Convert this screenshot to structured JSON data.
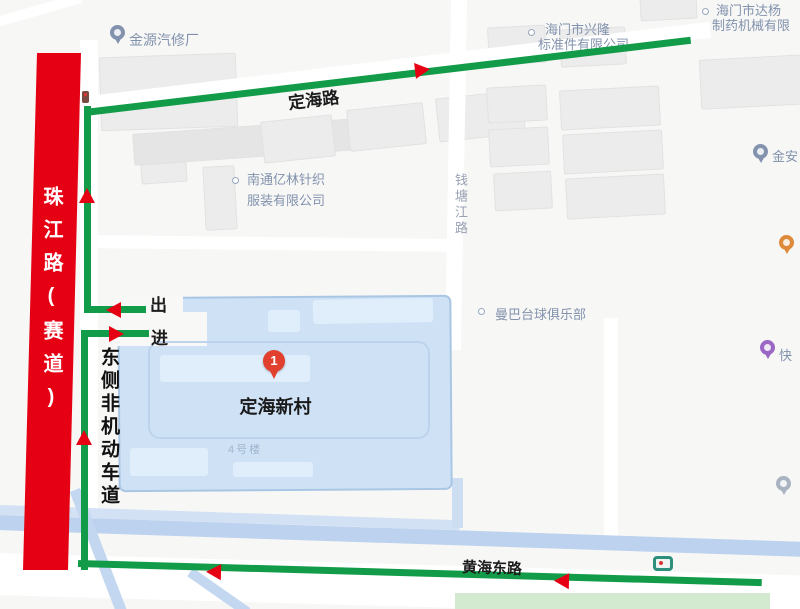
{
  "roads": {
    "dinghai": "定海路",
    "huanghai_east": "黄海东路",
    "zhujiang_racetrack": "珠江路(赛道)",
    "qiantangjiang": "钱塘江路",
    "east_non_motor_lane": "东侧非机动车道"
  },
  "route": {
    "exit_gate": "出",
    "enter_gate": "进"
  },
  "destination": {
    "marker_number": "1",
    "name": "定海新村",
    "building": "4号楼"
  },
  "pois": {
    "jinyuan_auto": "金源汽修厂",
    "xinglong": {
      "line1": "海门市兴隆",
      "line2": "标准件有限公司"
    },
    "dayang": {
      "line1": "海门市达杨",
      "line2": "制药机械有限"
    },
    "yilin": {
      "line1": "南通亿林针织",
      "line2": "服装有限公司"
    },
    "jinan": "金安",
    "manba_billiards": "曼巴台球俱乐部",
    "kuai": "快"
  },
  "colors": {
    "route_green": "#129c49",
    "closed_road_red": "#e60013",
    "arrow_red": "#e60013",
    "area_blue_fill": "#cfe2f5",
    "area_blue_border": "#a9c6e4",
    "water_road_blue": "#bcd2ee",
    "poi_text": "#8292ad",
    "destination_marker": "#e2402f"
  }
}
